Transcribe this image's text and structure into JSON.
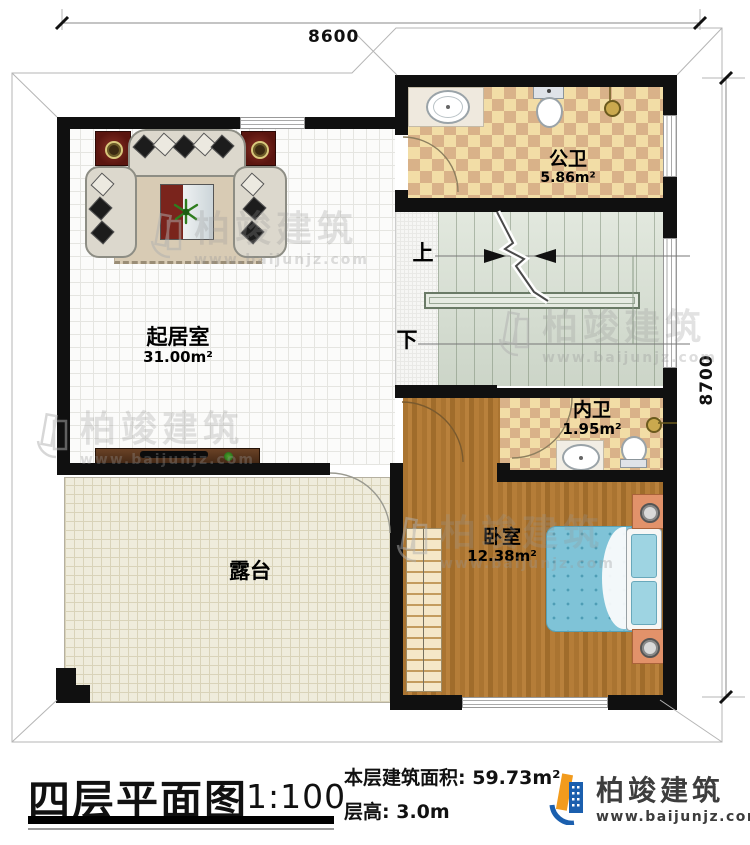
{
  "dims": {
    "top": "8600",
    "right": "8700"
  },
  "rooms": {
    "living": {
      "name": "起居室",
      "area": "31.00m²"
    },
    "public_bath": {
      "name": "公卫",
      "area": "5.86m²"
    },
    "inner_bath": {
      "name": "内卫",
      "area": "1.95m²"
    },
    "bedroom": {
      "name": "卧室",
      "area": "12.38m²"
    },
    "terrace": {
      "name": "露台"
    }
  },
  "stairs": {
    "up": "上",
    "down": "下"
  },
  "title_block": {
    "plan_name": "四层平面图",
    "scale": "1:100",
    "area_label": "本层建筑面积:",
    "area_value": "59.73m²",
    "height_label": "层高:",
    "height_value": "3.0m"
  },
  "brand": {
    "name": "柏竣建筑",
    "url": "www.baijunjz.com"
  },
  "watermark": {
    "name": "柏竣建筑",
    "url": "www.baijunjz.com"
  },
  "colors": {
    "wall": "#101010",
    "tile_light": "#f2dda6",
    "tile_dark": "#d9b289",
    "wood": "#aa7431",
    "stair_green": "#d5ddd0",
    "terrace_cream": "#efecdc",
    "bed_blue": "#7fc3d7",
    "brand_blue": "#1b5fae",
    "brand_orange": "#f29b1d"
  }
}
